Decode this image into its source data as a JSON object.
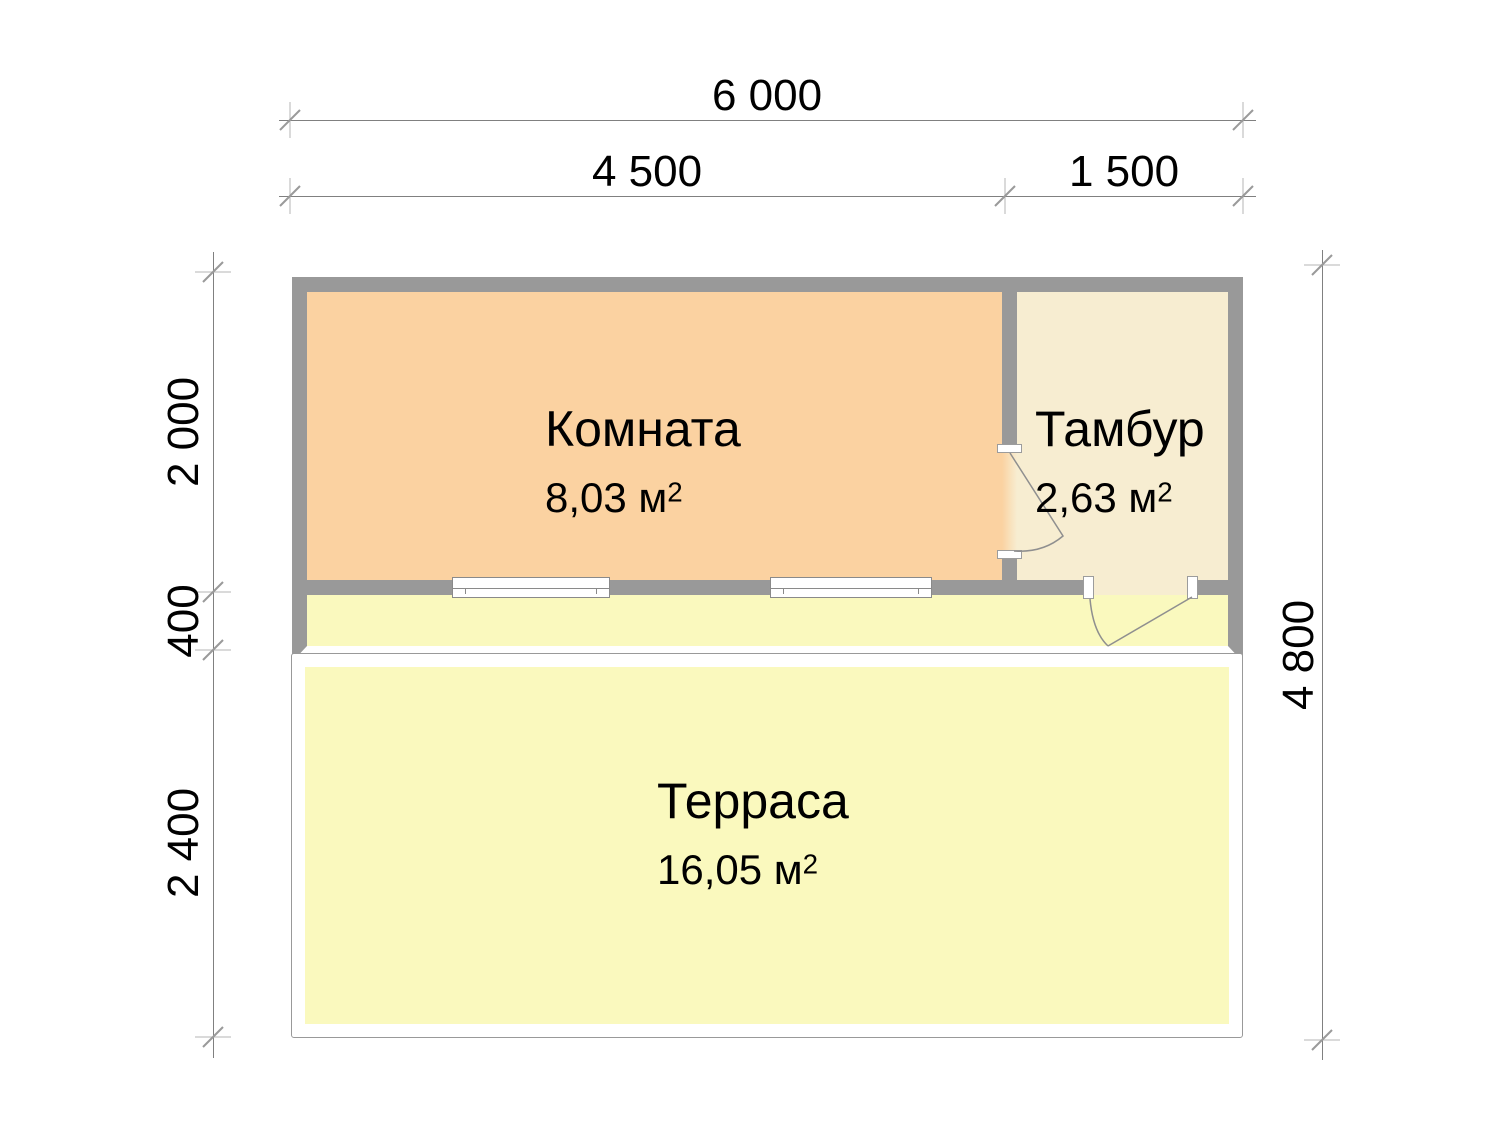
{
  "dimensions": {
    "overall_width": "6 000",
    "komnata_span": "4 500",
    "tambur_span": "1 500",
    "komnata_depth": "2 000",
    "porch_depth": "400",
    "terrace_depth": "2 400",
    "overall_depth": "4 800"
  },
  "rooms": {
    "komnata": {
      "name": "Комната",
      "area": "8,03 м",
      "area_sup": "2"
    },
    "tambur": {
      "name": "Тамбур",
      "area": "2,63 м",
      "area_sup": "2"
    },
    "terrasa": {
      "name": "Терраса",
      "area": "16,05 м",
      "area_sup": "2"
    }
  },
  "colors": {
    "wall": "#999999",
    "komnata_fill": "#fbd2a1",
    "tambur_fill": "#f7edd1",
    "terrace_fill": "#faf9be",
    "dim_line": "#808080",
    "tick": "#9a9a9a",
    "ext_tick": "#b5b5b5",
    "frame_line": "#8a8a8a"
  }
}
